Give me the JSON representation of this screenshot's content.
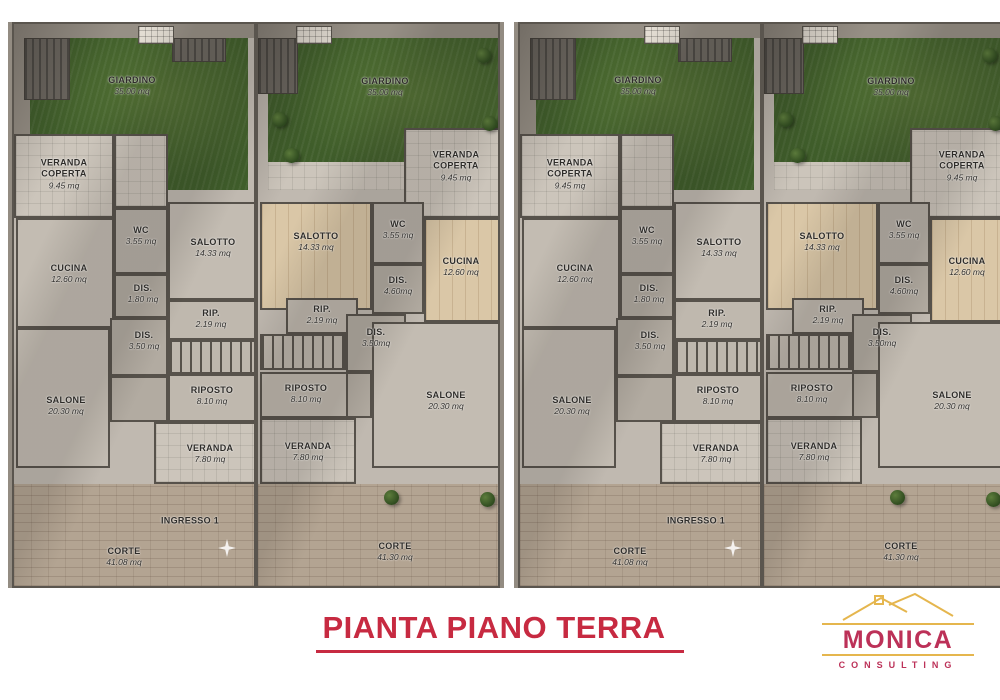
{
  "title": {
    "text": "PIANTA PIANO TERRA"
  },
  "brand": {
    "name": "MONICA",
    "subtitle": "CONSULTING"
  },
  "colors": {
    "title_red": "#c72a41",
    "brand_pink": "#bc3158",
    "brand_gold": "#e5b64e",
    "grass_green": "#3f5d2a",
    "wood_floor": "#dac7a7",
    "court_pavement": "#b3a492",
    "interior_gray": "#c0b9b0"
  },
  "plan_a": {
    "rooms": {
      "giardino": {
        "name": "GIARDINO",
        "area": "35.00 mq"
      },
      "veranda_coperta": {
        "name": "VERANDA COPERTA",
        "area": "9.45 mq"
      },
      "wc": {
        "name": "WC",
        "area": "3.55 mq"
      },
      "salotto": {
        "name": "SALOTTO",
        "area": "14.33 mq"
      },
      "cucina": {
        "name": "CUCINA",
        "area": "12.60 mq"
      },
      "dis_piccolo": {
        "name": "DIS.",
        "area": "1.80 mq"
      },
      "rip": {
        "name": "RIP.",
        "area": "2.19 mq"
      },
      "dis": {
        "name": "DIS.",
        "area": "3.50 mq"
      },
      "riposto": {
        "name": "RIPOSTO",
        "area": "8.10 mq"
      },
      "salone": {
        "name": "SALONE",
        "area": "20.30 mq"
      },
      "veranda": {
        "name": "VERANDA",
        "area": "7.80 mq"
      },
      "ingresso": {
        "name": "INGRESSO 1"
      },
      "corte": {
        "name": "CORTE",
        "area": "41.08 mq"
      }
    }
  },
  "plan_b": {
    "rooms": {
      "giardino": {
        "name": "GIARDINO",
        "area": "35.00 mq"
      },
      "veranda_coperta": {
        "name": "VERANDA COPERTA",
        "area": "9.45 mq"
      },
      "salotto": {
        "name": "SALOTTO",
        "area": "14.33 mq"
      },
      "wc": {
        "name": "WC",
        "area": "3.55 mq"
      },
      "cucina": {
        "name": "CUCINA",
        "area": "12.60 mq"
      },
      "dis_grande": {
        "name": "DIS.",
        "area": "4.60mq"
      },
      "rip": {
        "name": "RIP.",
        "area": "2.19 mq"
      },
      "dis": {
        "name": "DIS.",
        "area": "3.50mq"
      },
      "riposto": {
        "name": "RIPOSTO",
        "area": "8.10 mq"
      },
      "salone": {
        "name": "SALONE",
        "area": "20.30 mq"
      },
      "veranda": {
        "name": "VERANDA",
        "area": "7.80 mq"
      },
      "corte": {
        "name": "CORTE",
        "area": "41.30 mq"
      }
    }
  }
}
